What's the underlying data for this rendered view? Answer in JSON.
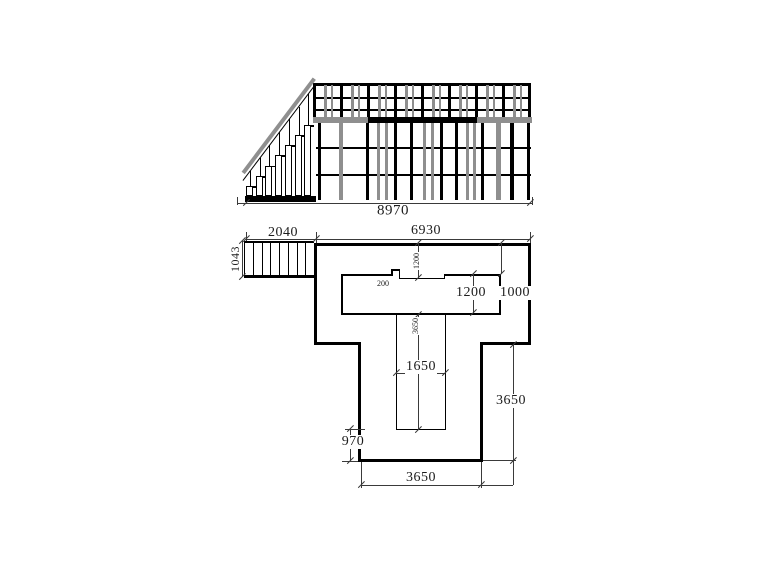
{
  "drawing": {
    "type": "scaffold-elevation-and-plan",
    "colors": {
      "outline": "#000000",
      "scaffold_gray": "#8f8f8f",
      "dimension_line": "#3a3a3a",
      "text": "#1c1c1c",
      "background": "#ffffff"
    },
    "elevation": {
      "overall_width": "8970"
    },
    "plan": {
      "stair_width": "2040",
      "platform_width": "6930",
      "stair_depth": "1043",
      "notch_step": "200",
      "notch_total_depth": "1200",
      "opening_depth": "1200",
      "edge_margin": "1000",
      "stem_opening_width": "1650",
      "stem_opening_length": "3650",
      "bottom_margin": "970",
      "stem_side_length": "3650",
      "stem_width": "3650"
    }
  }
}
